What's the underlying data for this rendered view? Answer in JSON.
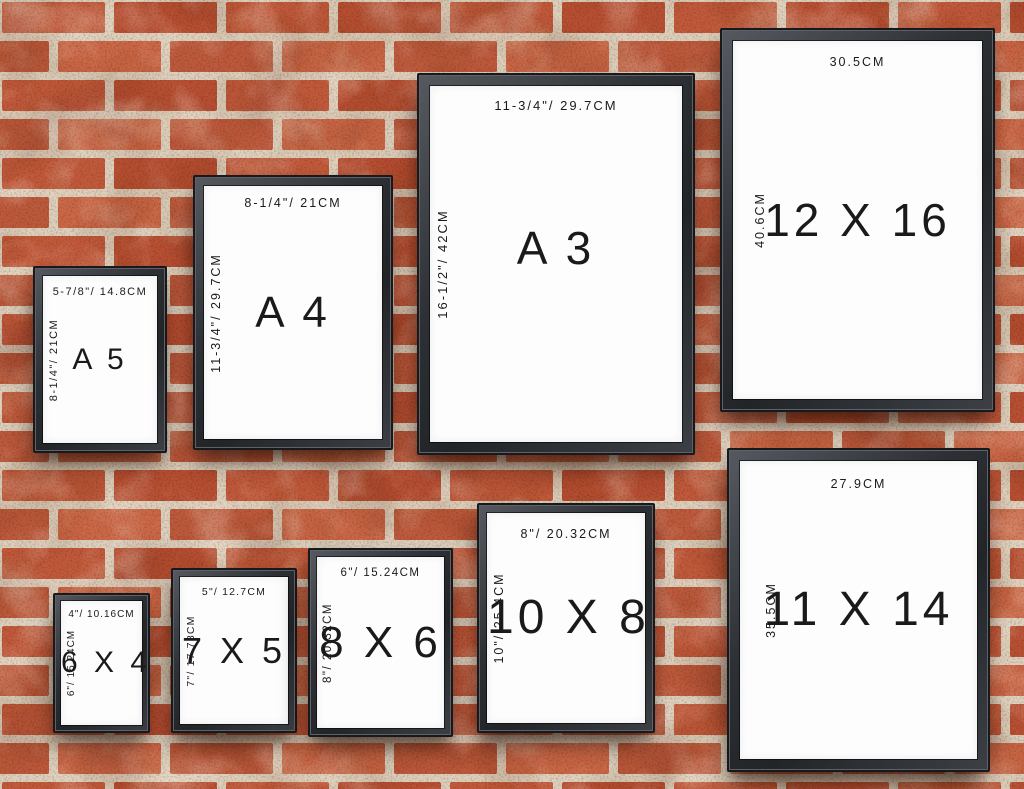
{
  "frames": [
    {
      "id": "a5",
      "name": "A 5",
      "top_label": "5-7/8\"/ 14.8CM",
      "side_label": "8-1/4\"/ 21CM"
    },
    {
      "id": "a4",
      "name": "A 4",
      "top_label": "8-1/4\"/ 21CM",
      "side_label": "11-3/4\"/ 29.7CM"
    },
    {
      "id": "a3",
      "name": "A 3",
      "top_label": "11-3/4\"/ 29.7CM",
      "side_label": "16-1/2\"/ 42CM"
    },
    {
      "id": "12x16",
      "name": "12 X 16",
      "top_label": "30.5CM",
      "side_label": "40.6CM"
    },
    {
      "id": "6x4",
      "name": "6 X 4",
      "top_label": "4\"/ 10.16CM",
      "side_label": "6\"/ 15.24CM"
    },
    {
      "id": "7x5",
      "name": "7 X 5",
      "top_label": "5\"/ 12.7CM",
      "side_label": "7\"/ 17.78CM"
    },
    {
      "id": "8x6",
      "name": "8 X 6",
      "top_label": "6\"/ 15.24CM",
      "side_label": "8\"/ 20.32CM"
    },
    {
      "id": "10x8",
      "name": "10 X 8",
      "top_label": "8\"/ 20.32CM",
      "side_label": "10\"/ 25.4CM"
    },
    {
      "id": "11x14",
      "name": "11 X 14",
      "top_label": "27.9CM",
      "side_label": "35.5CM"
    }
  ],
  "colors": {
    "brick": "#c15a3b",
    "brick_dark": "#b85033",
    "brick_light": "#cb6847",
    "mortar": "#ddd0bc",
    "frame_black": "#2b2e32",
    "paper_white": "#fdfdfd",
    "label_text": "#1a1a1a"
  }
}
